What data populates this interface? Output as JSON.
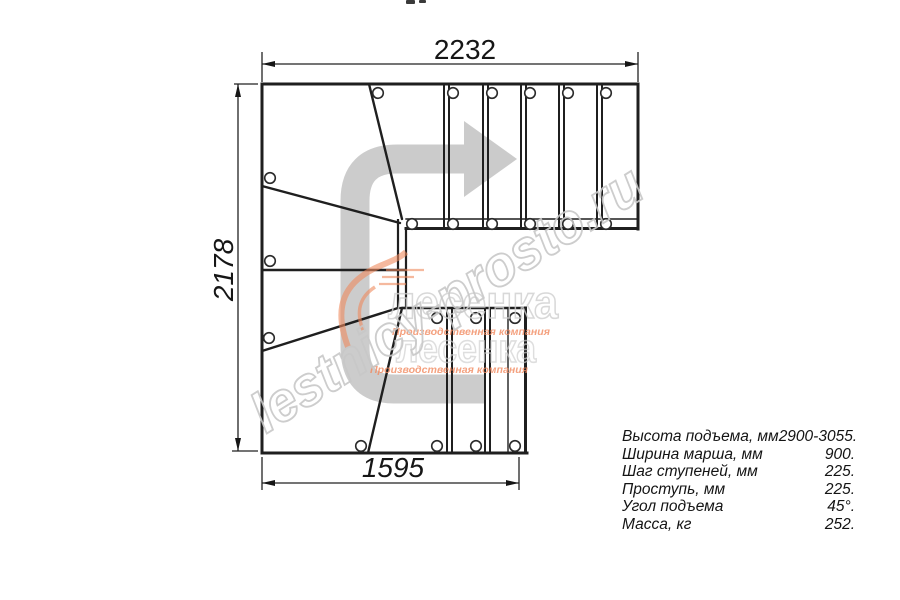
{
  "dimensions": {
    "top": "2232",
    "left": "2178",
    "bottom": "1595"
  },
  "specs": {
    "rows": [
      {
        "label": "Высота подъема, мм",
        "value": "2900-3055."
      },
      {
        "label": "Ширина марша, мм",
        "value": "900."
      },
      {
        "label": "Шаг ступеней, мм",
        "value": "225."
      },
      {
        "label": "Проступь, мм",
        "value": "225."
      },
      {
        "label": "Угол подъема",
        "value": "45°."
      },
      {
        "label": "Масса, кг",
        "value": "252."
      }
    ]
  },
  "watermark": {
    "site": "lestnicy-prosto.ru",
    "brand": "лесенка",
    "tagline": "Производственная компания"
  },
  "icons": {
    "direction_arrow": "curved-arrow-right"
  },
  "colors": {
    "line": "#1f1f1f",
    "dimension": "#222222",
    "watermark_gray": "#c8c8c8",
    "brand_orange": "#f28a60",
    "arrow_gray": "#787878"
  }
}
